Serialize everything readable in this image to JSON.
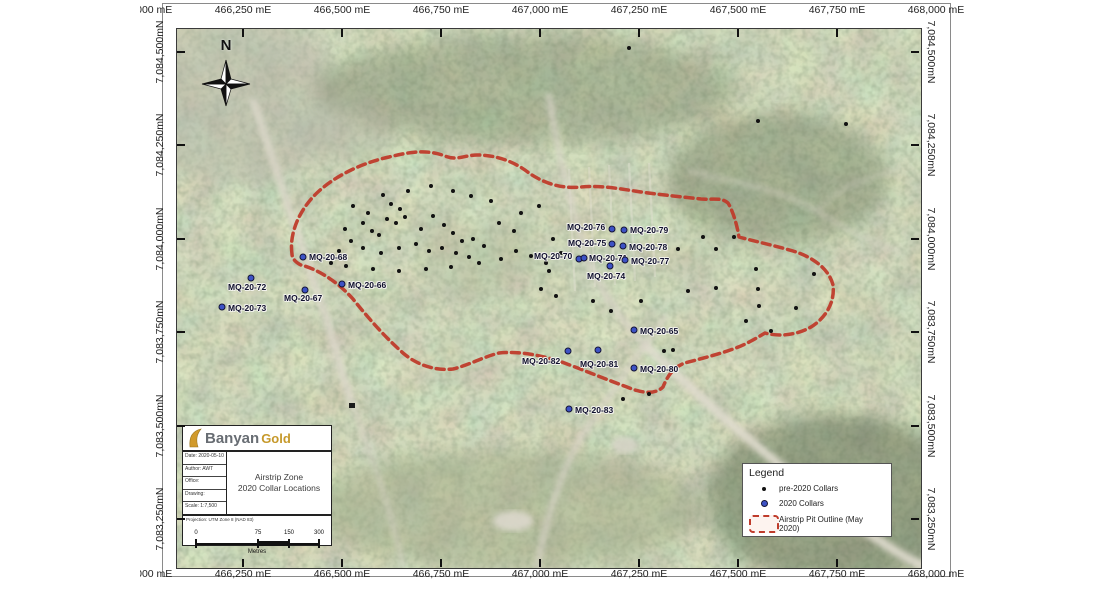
{
  "map": {
    "north_label": "N",
    "easting_labels": [
      "466,000 mE",
      "466,250 mE",
      "466,500 mE",
      "466,750 mE",
      "467,000 mE",
      "467,250 mE",
      "467,500 mE",
      "467,750 mE",
      "468,000 mE"
    ],
    "northing_labels": [
      "7,084,500mN",
      "7,084,250mN",
      "7,084,000mN",
      "7,083,750mN",
      "7,083,500mN",
      "7,083,250mN"
    ],
    "colors": {
      "pre2020_dot": "#121212",
      "collar2020_dot": "#3d52c5",
      "pit_outline": "#bf3b2b"
    },
    "pit_outline_path": "M 115,225 C 112,205 122,180 142,162 C 160,146 185,134 212,128 C 232,123 250,120 268,127 C 280,132 288,126 300,126 C 320,126 338,133 352,144 C 368,155 386,160 404,158 C 424,156 444,160 464,163 C 486,166 506,168 524,170 C 536,171 544,168 551,174 C 556,182 560,196 562,208 C 576,212 596,216 616,222 C 636,228 652,240 656,256 C 658,272 650,288 634,298 C 620,306 602,308 588,304 C 578,310 568,316 556,320 C 540,326 522,330 508,334 C 496,338 490,348 486,358 C 478,366 464,364 450,358 C 428,350 404,340 382,332 C 362,326 342,322 322,324 C 306,328 292,336 276,340 C 258,342 240,336 226,324 C 208,308 192,290 176,270 C 160,252 140,240 124,236 C 118,233 115,229 115,225 Z",
    "collars_2020": [
      {
        "label": "MQ-20-68",
        "dot": [
          126,
          228
        ],
        "text": [
          132,
          223
        ]
      },
      {
        "label": "MQ-20-72",
        "dot": [
          74,
          249
        ],
        "text": [
          51,
          253
        ]
      },
      {
        "label": "MQ-20-66",
        "dot": [
          165,
          255
        ],
        "text": [
          171,
          251
        ]
      },
      {
        "label": "MQ-20-67",
        "dot": [
          128,
          261
        ],
        "text": [
          107,
          264
        ]
      },
      {
        "label": "MQ-20-73",
        "dot": [
          45,
          278
        ],
        "text": [
          51,
          274
        ]
      },
      {
        "label": "MQ-20-76",
        "dot": [
          435,
          200
        ],
        "text": [
          390,
          193
        ]
      },
      {
        "label": "MQ-20-79",
        "dot": [
          447,
          201
        ],
        "text": [
          453,
          196
        ]
      },
      {
        "label": "MQ-20-75",
        "dot": [
          435,
          215
        ],
        "text": [
          391,
          209
        ]
      },
      {
        "label": "MQ-20-78",
        "dot": [
          446,
          217
        ],
        "text": [
          452,
          213
        ]
      },
      {
        "label": "MQ-20-70",
        "dot": [
          402,
          230
        ],
        "text": [
          357,
          222
        ]
      },
      {
        "label": "MQ-20-71",
        "dot": [
          407,
          229
        ],
        "text": [
          412,
          224
        ]
      },
      {
        "label": "MQ-20-77",
        "dot": [
          448,
          231
        ],
        "text": [
          454,
          227
        ]
      },
      {
        "label": "MQ-20-74",
        "dot": [
          433,
          237
        ],
        "text": [
          410,
          242
        ]
      },
      {
        "label": "MQ-20-65",
        "dot": [
          457,
          301
        ],
        "text": [
          463,
          297
        ]
      },
      {
        "label": "MQ-20-82",
        "dot": [
          391,
          322
        ],
        "text": [
          345,
          327
        ]
      },
      {
        "label": "MQ-20-81",
        "dot": [
          421,
          321
        ],
        "text": [
          403,
          330
        ]
      },
      {
        "label": "MQ-20-80",
        "dot": [
          457,
          339
        ],
        "text": [
          463,
          335
        ]
      },
      {
        "label": "MQ-20-83",
        "dot": [
          392,
          380
        ],
        "text": [
          398,
          376
        ]
      }
    ],
    "pre2020_dots": [
      [
        206,
        166
      ],
      [
        231,
        162
      ],
      [
        176,
        177
      ],
      [
        191,
        184
      ],
      [
        214,
        175
      ],
      [
        223,
        180
      ],
      [
        228,
        188
      ],
      [
        186,
        194
      ],
      [
        168,
        200
      ],
      [
        195,
        202
      ],
      [
        202,
        206
      ],
      [
        210,
        190
      ],
      [
        219,
        194
      ],
      [
        244,
        200
      ],
      [
        256,
        187
      ],
      [
        267,
        196
      ],
      [
        276,
        204
      ],
      [
        285,
        212
      ],
      [
        296,
        210
      ],
      [
        307,
        217
      ],
      [
        265,
        219
      ],
      [
        279,
        224
      ],
      [
        292,
        228
      ],
      [
        252,
        222
      ],
      [
        239,
        215
      ],
      [
        222,
        219
      ],
      [
        204,
        224
      ],
      [
        186,
        219
      ],
      [
        174,
        212
      ],
      [
        162,
        222
      ],
      [
        154,
        234
      ],
      [
        169,
        237
      ],
      [
        196,
        240
      ],
      [
        222,
        242
      ],
      [
        249,
        240
      ],
      [
        274,
        238
      ],
      [
        302,
        234
      ],
      [
        324,
        230
      ],
      [
        339,
        222
      ],
      [
        354,
        227
      ],
      [
        369,
        234
      ],
      [
        337,
        202
      ],
      [
        322,
        194
      ],
      [
        344,
        184
      ],
      [
        362,
        177
      ],
      [
        314,
        172
      ],
      [
        294,
        167
      ],
      [
        276,
        162
      ],
      [
        254,
        157
      ],
      [
        376,
        210
      ],
      [
        384,
        224
      ],
      [
        372,
        242
      ],
      [
        364,
        260
      ],
      [
        379,
        267
      ],
      [
        416,
        272
      ],
      [
        434,
        282
      ],
      [
        464,
        272
      ],
      [
        501,
        220
      ],
      [
        526,
        208
      ],
      [
        539,
        220
      ],
      [
        557,
        208
      ],
      [
        579,
        240
      ],
      [
        637,
        245
      ],
      [
        581,
        260
      ],
      [
        539,
        259
      ],
      [
        582,
        277
      ],
      [
        619,
        279
      ],
      [
        511,
        262
      ],
      [
        569,
        292
      ],
      [
        594,
        302
      ],
      [
        487,
        322
      ],
      [
        496,
        321
      ],
      [
        472,
        365
      ],
      [
        446,
        370
      ],
      [
        581,
        92
      ],
      [
        669,
        95
      ],
      [
        452,
        19
      ]
    ],
    "building": {
      "x": 172,
      "y": 374,
      "w": 6,
      "h": 5
    }
  },
  "legend": {
    "title": "Legend",
    "items": [
      {
        "name": "pre-2020 Collars"
      },
      {
        "name": "2020 Collars"
      },
      {
        "name": "Airstrip Pit Outline (May 2020)"
      }
    ]
  },
  "title_block": {
    "company_1": "Banyan",
    "company_2": "Gold",
    "title_line1": "Airstrip Zone",
    "title_line2": "2020 Collar Locations",
    "meta_rows": [
      "Date: 2020-05-10",
      "Author: AWT",
      "Office:",
      "Drawing:",
      "Scale: 1:7,500"
    ],
    "projection": "Projection: UTM Zone 8 (NAD 83)",
    "scale_bar": {
      "ticks": [
        "0",
        "75",
        "150",
        "300"
      ],
      "unit": "Metres"
    }
  }
}
